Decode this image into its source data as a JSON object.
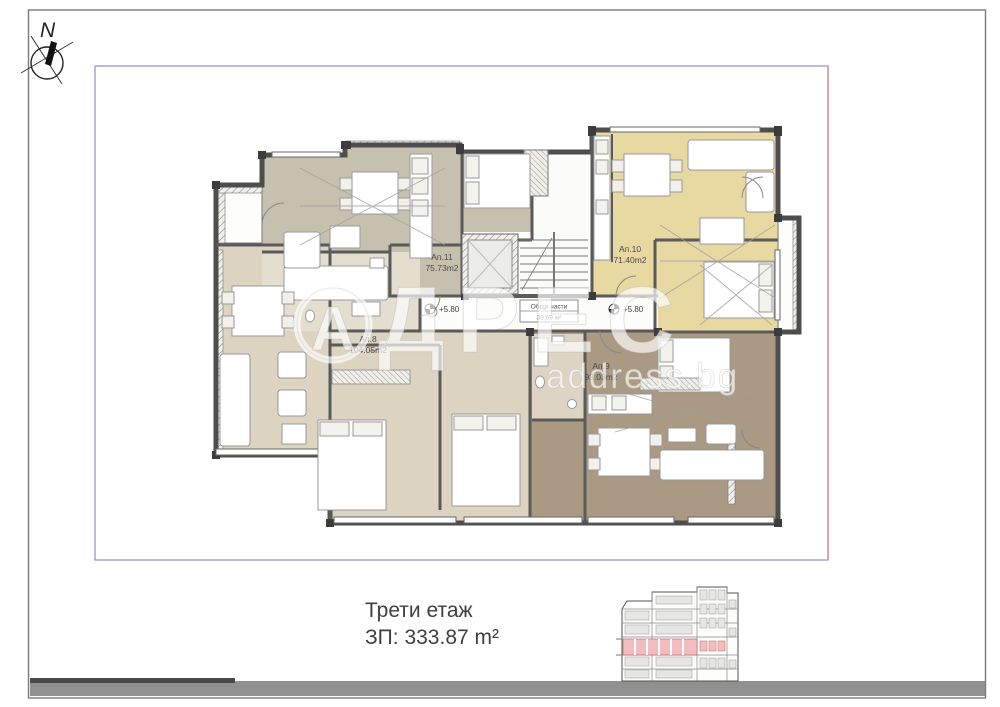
{
  "compass": {
    "label": "N"
  },
  "plan": {
    "apartments": [
      {
        "name": "Ап.11",
        "area": "75.73m2",
        "color": "#c6c1af"
      },
      {
        "name": "Ап.10",
        "area": "71.40m2",
        "color": "#e8d8a2"
      },
      {
        "name": "Ап.8",
        "area": "104.05m2",
        "color": "#dcd4c1"
      },
      {
        "name": "Ап.9",
        "area": "93.03m2",
        "color": "#aa9983"
      }
    ],
    "common_area": {
      "name": "Общи части",
      "area": "38.69 м²"
    },
    "level_markers": [
      "+5.80",
      "+5.80"
    ],
    "boundary": {
      "lot_color": "#9090c8",
      "building_line_color": "#d08c8c"
    },
    "wall_color": "#4d4d4d"
  },
  "watermark": {
    "logo_letter": "А",
    "brand_rest": "ДРЕС",
    "domain": "address.bg"
  },
  "footer": {
    "floor": "Трети етаж",
    "built_area": "ЗП: 333.87 m²"
  },
  "elevation": {
    "highlight_color": "#f3bcbf"
  }
}
